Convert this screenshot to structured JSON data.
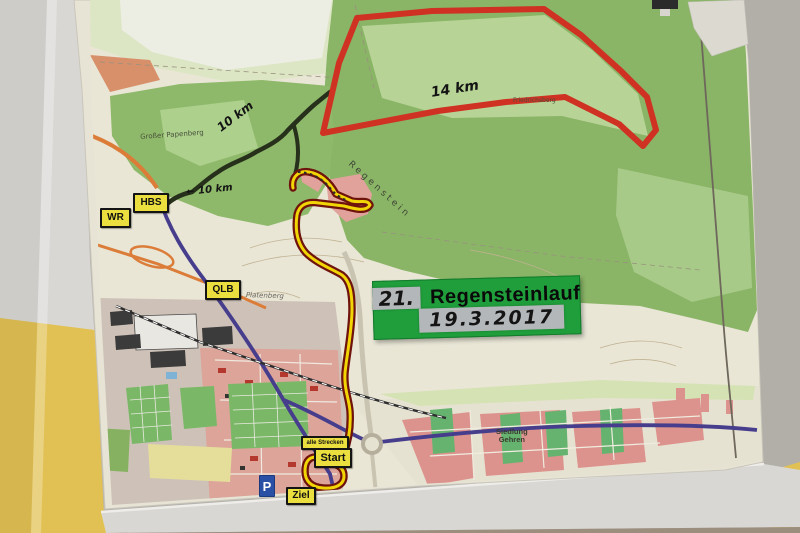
{
  "event_sign": {
    "edition": "21.",
    "title": "Regensteinlauf",
    "date": "19.3.2017",
    "bg": "#1f9e3b"
  },
  "route_labels": {
    "red_distance": "14 km",
    "black_distance": "10 km",
    "black_distance_with_arrow": "← 10 km"
  },
  "signs": {
    "wr": "WR",
    "hbs": "HBS",
    "qlb": "QLB",
    "alle_strecken": "alle Strecken",
    "start": "Start",
    "ziel": "Ziel",
    "parking": "P"
  },
  "places": {
    "grosser_papenberg": "Großer Papenberg",
    "regenstein": "Regenstein",
    "friedrichsberg": "Friedrichsberg",
    "platenberg": "Platenberg",
    "siedlung_line1": "Siedlung",
    "siedlung_line2": "Gehren"
  },
  "routes": {
    "red": {
      "color": "#cf3122",
      "distance": "14 km"
    },
    "black": {
      "color": "#26301b",
      "distance": "10 km"
    },
    "yellow": {
      "color": "#f2d504",
      "outline": "#6f130d",
      "label": "alle Strecken"
    }
  },
  "wall_colors": {
    "yellow": "#e2c154",
    "grey": "#b2afa9",
    "white": "#d9d7d4"
  }
}
